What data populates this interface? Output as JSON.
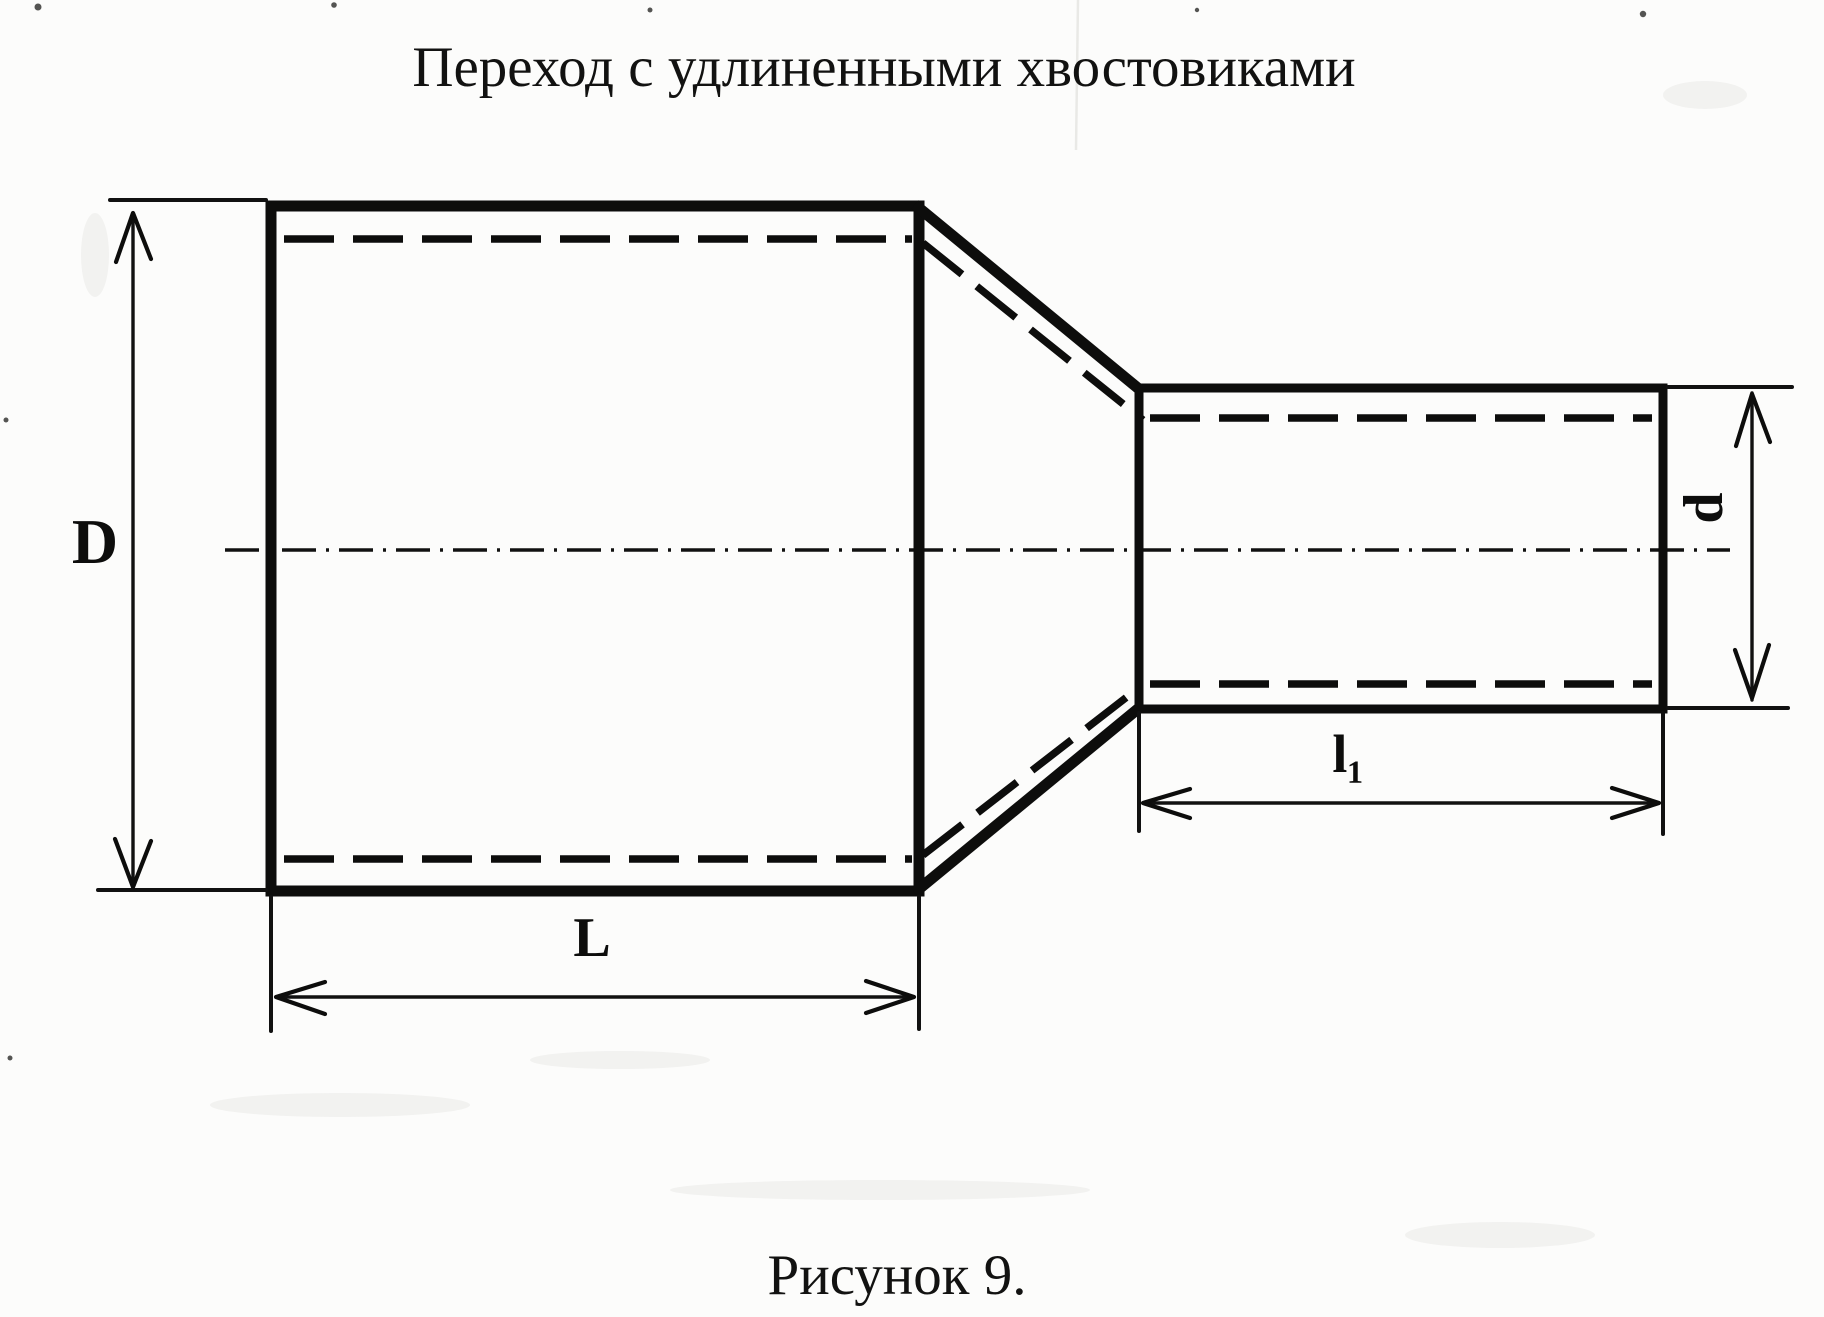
{
  "figure": {
    "title": "Переход с удлиненными хвостовиками",
    "caption": "Рисунок 9.",
    "type": "technical-drawing",
    "subject": "pipe reducer with elongated shanks, longitudinal section view"
  },
  "dimensions": {
    "large_diameter_label": "D",
    "small_diameter_label": "d",
    "large_body_length_label": "L",
    "small_shank_length_label": "l₁"
  },
  "colors": {
    "ink": "#0d0d0c",
    "paper": "#fcfcfb"
  }
}
